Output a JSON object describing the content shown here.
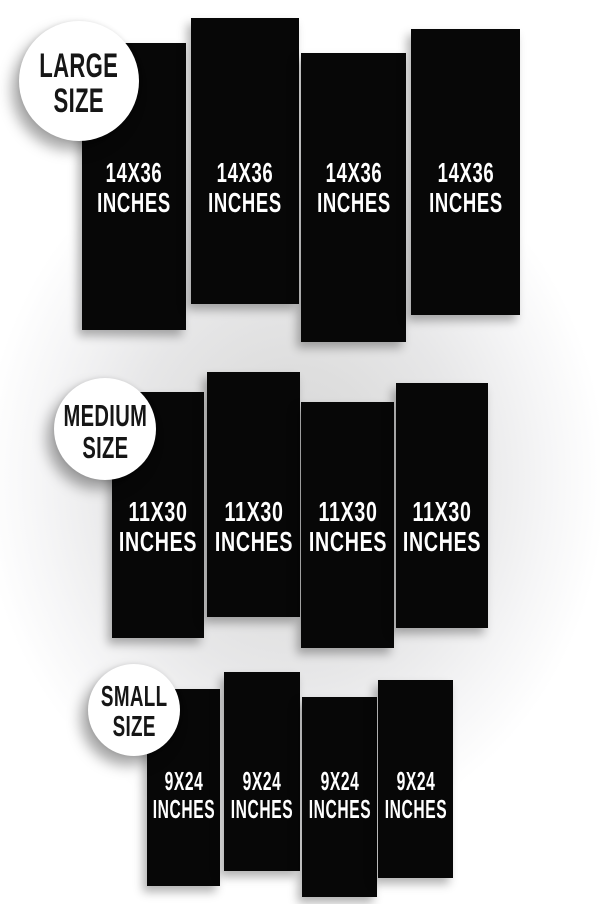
{
  "title": "Banner size comparison",
  "colors": {
    "background_center": "#d6d6d7",
    "background_edge": "#ffffff",
    "panel": "#070707",
    "panel_text": "#ffffff",
    "badge_bg": "#ffffff",
    "badge_text": "#161616"
  },
  "groups": [
    {
      "id": "large",
      "badge": {
        "line1": "LARGE",
        "line2": "SIZE",
        "x": 19,
        "y": 21,
        "d": 120
      },
      "panel_label": {
        "line1": "14X36",
        "line2": "INCHES"
      },
      "label_center_y": 188,
      "panels": [
        {
          "x": 82,
          "y": 43,
          "w": 104,
          "h": 287
        },
        {
          "x": 191,
          "y": 18,
          "w": 108,
          "h": 286
        },
        {
          "x": 301,
          "y": 53,
          "w": 105,
          "h": 289
        },
        {
          "x": 411,
          "y": 29,
          "w": 109,
          "h": 286
        }
      ]
    },
    {
      "id": "medium",
      "badge": {
        "line1": "MEDIUM",
        "line2": "SIZE",
        "x": 54,
        "y": 378,
        "d": 102
      },
      "panel_label": {
        "line1": "11X30",
        "line2": "INCHES"
      },
      "label_center_y": 527,
      "panels": [
        {
          "x": 112,
          "y": 392,
          "w": 92,
          "h": 246
        },
        {
          "x": 207,
          "y": 372,
          "w": 93,
          "h": 245
        },
        {
          "x": 301,
          "y": 402,
          "w": 93,
          "h": 246
        },
        {
          "x": 396,
          "y": 383,
          "w": 92,
          "h": 245
        }
      ]
    },
    {
      "id": "small",
      "badge": {
        "line1": "SMALL",
        "line2": "SIZE",
        "x": 88,
        "y": 664,
        "d": 92
      },
      "panel_label": {
        "line1": "9X24",
        "line2": "INCHES"
      },
      "label_center_y": 796,
      "panels": [
        {
          "x": 147,
          "y": 689,
          "w": 73,
          "h": 197
        },
        {
          "x": 224,
          "y": 672,
          "w": 76,
          "h": 199
        },
        {
          "x": 302,
          "y": 697,
          "w": 75,
          "h": 200
        },
        {
          "x": 378,
          "y": 680,
          "w": 75,
          "h": 198
        }
      ]
    }
  ]
}
